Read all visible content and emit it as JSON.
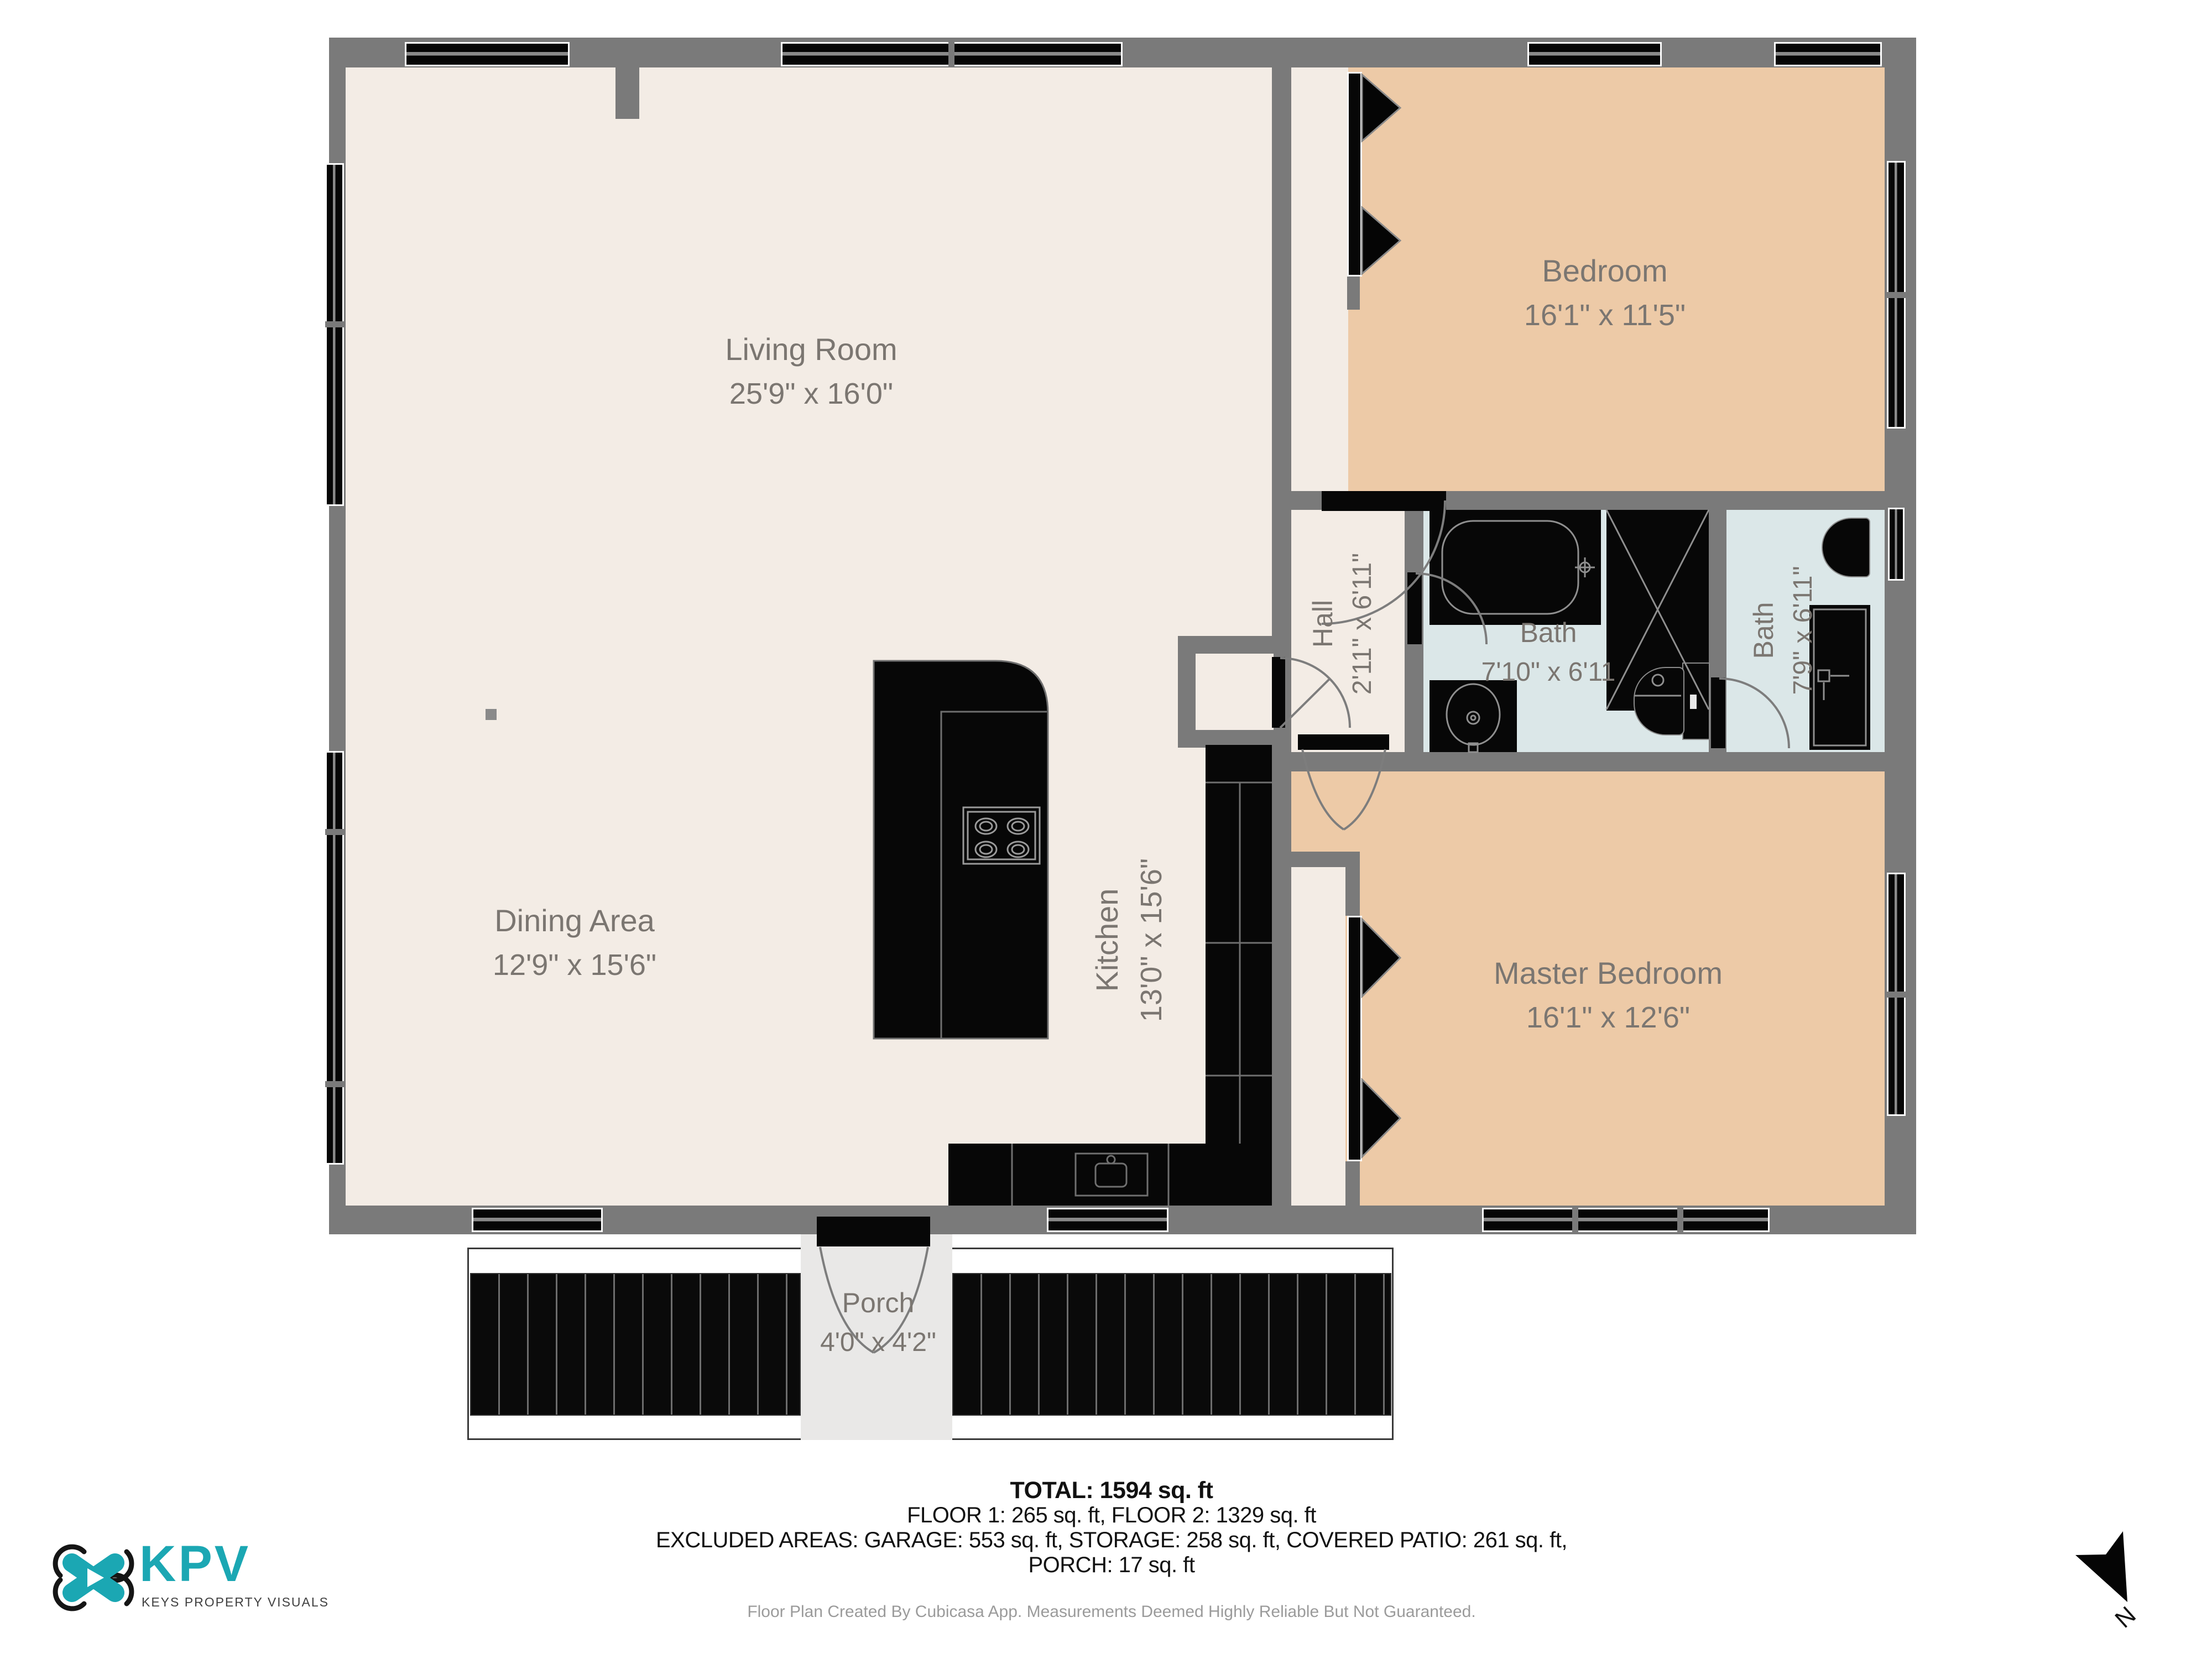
{
  "plan": {
    "rooms": {
      "living_room": {
        "name": "Living Room",
        "dims": "25'9\" x 16'0\""
      },
      "dining_area": {
        "name": "Dining Area",
        "dims": "12'9\" x 15'6\""
      },
      "kitchen": {
        "name": "Kitchen",
        "dims": "13'0\" x 15'6\""
      },
      "hall": {
        "name": "Hall",
        "dims": "2'11\" x 6'11\""
      },
      "bath_1": {
        "name": "Bath",
        "dims": "7'10\" x 6'11"
      },
      "bath_2": {
        "name": "Bath",
        "dims": "7'9\" x 6'11\""
      },
      "bedroom": {
        "name": "Bedroom",
        "dims": "16'1\" x 11'5\""
      },
      "master_bedroom": {
        "name": "Master Bedroom",
        "dims": "16'1\" x 12'6\""
      },
      "porch": {
        "name": "Porch",
        "dims": "4'0\" x 4'2\""
      }
    },
    "colors": {
      "wall": "#7a7a7a",
      "floor_main": "#f3ece5",
      "floor_bedroom": "#edcaa7",
      "floor_bath": "#dbe7e8",
      "fixture": "#070707",
      "label_text": "#7b7671"
    }
  },
  "summary": {
    "total": "TOTAL: 1594 sq. ft",
    "floors": "FLOOR 1: 265 sq. ft, FLOOR 2: 1329 sq. ft",
    "excluded": "EXCLUDED AREAS: GARAGE: 553 sq. ft, STORAGE: 258 sq. ft, COVERED PATIO: 261 sq. ft,",
    "porch_line": "PORCH: 17 sq. ft",
    "credit": "Floor Plan Created By Cubicasa App. Measurements Deemed Highly Reliable But Not Guaranteed."
  },
  "branding": {
    "logo_text": "KPV",
    "tagline": "KEYS PROPERTY VISUALS",
    "accent_color": "#1ba7b3"
  },
  "compass": {
    "label": "N"
  }
}
